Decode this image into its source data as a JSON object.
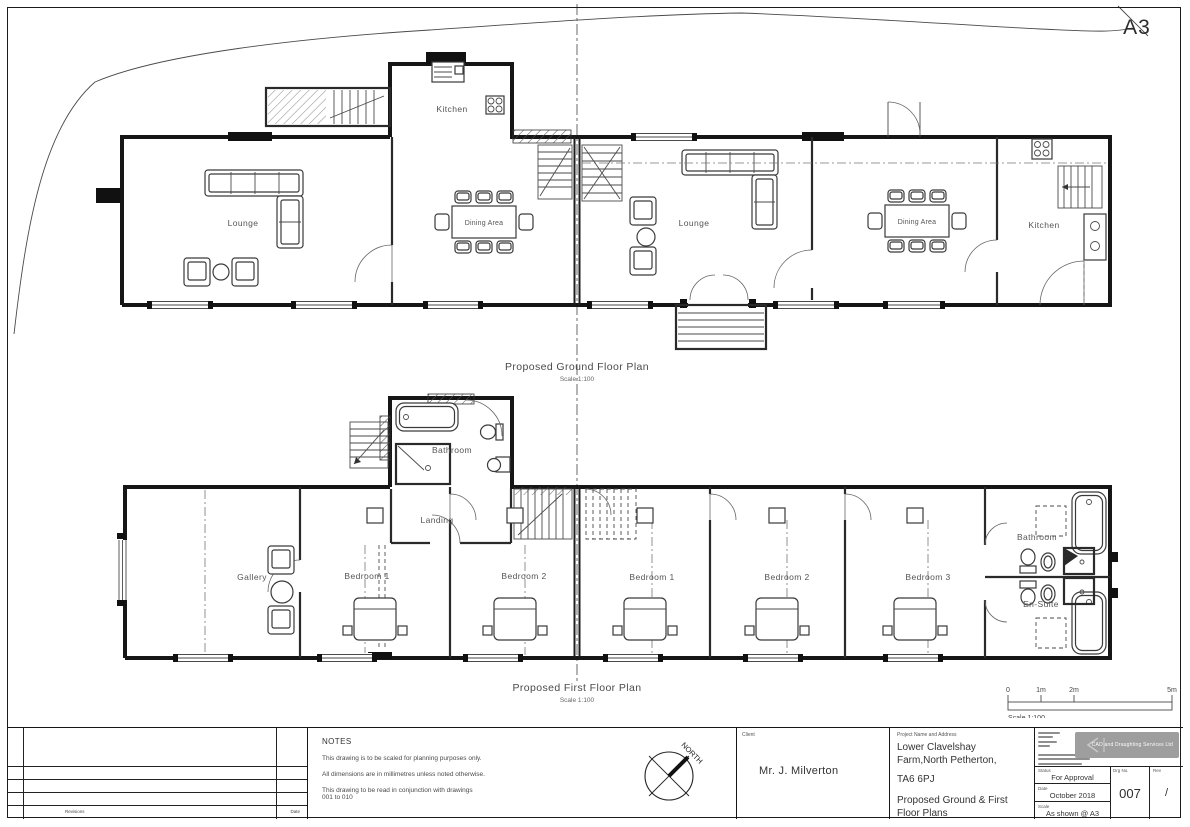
{
  "sheet": {
    "format_label": "A3"
  },
  "ground_floor": {
    "title": "Proposed Ground Floor Plan",
    "scale_note": "Scale 1:100",
    "rooms": {
      "lounge_left": "Lounge",
      "kitchen_left": "Kitchen",
      "dining_left": "Dining Area",
      "lounge_right": "Lounge",
      "dining_right": "Dining Area",
      "kitchen_right": "Kitchen"
    }
  },
  "first_floor": {
    "title": "Proposed First Floor Plan",
    "scale_note": "Scale 1:100",
    "rooms": {
      "bathroom_top": "Bathroom",
      "landing": "Landing",
      "gallery": "Gallery",
      "bedroom1_left": "Bedroom 1",
      "bedroom2_left": "Bedroom 2",
      "bedroom1_right": "Bedroom 1",
      "bedroom2_right": "Bedroom 2",
      "bedroom3_right": "Bedroom 3",
      "bathroom_right": "Bathroom",
      "ensuite": "En-Suite"
    }
  },
  "scale_bar": {
    "ticks": [
      "0",
      "1m",
      "2m",
      "5m"
    ],
    "label": "Scale 1:100"
  },
  "north_arrow": {
    "label": "NORTH"
  },
  "title_block": {
    "revisions": {
      "footer_left": "Revisions",
      "footer_right": "Date"
    },
    "notes": {
      "heading": "NOTES",
      "lines": [
        "This drawing is to be scaled for planning purposes only.",
        "All dimensions are in millimetres unless noted otherwise.",
        "This drawing to be read in conjunction with drawings",
        "001 to 010"
      ]
    },
    "client": {
      "label": "Client",
      "name": "Mr. J. Milverton"
    },
    "project": {
      "label": "Project Name and Address",
      "address_line1": "Lower Clavelshay",
      "address_line2": "Farm,North Petherton,",
      "postcode": "TA6 6PJ",
      "title_line1": "Proposed Ground & First",
      "title_line2": "Floor Plans"
    },
    "company": {
      "logo_text": "CAD and Draughting Services Ltd"
    },
    "status": {
      "label": "Status",
      "value": "For Approval"
    },
    "date": {
      "label": "Date",
      "value": "October 2018"
    },
    "scale": {
      "label": "Scale",
      "value": "As shown @ A3"
    },
    "drg_no": {
      "label": "Drg No.",
      "value": "007"
    },
    "rev": {
      "label": "Rev",
      "value": "/"
    }
  }
}
